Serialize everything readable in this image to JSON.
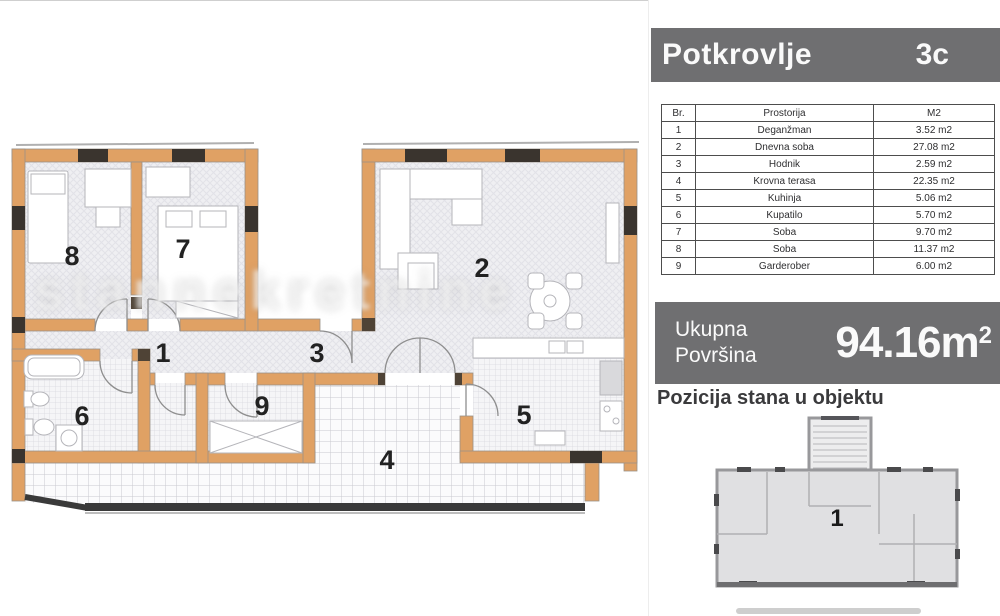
{
  "header": {
    "title": "Potkrovlje",
    "unit": "3c"
  },
  "table": {
    "columns": [
      "Br.",
      "Prostorija",
      "M2"
    ],
    "rows": [
      [
        "1",
        "Deganžman",
        "3.52 m2"
      ],
      [
        "2",
        "Dnevna soba",
        "27.08 m2"
      ],
      [
        "3",
        "Hodnik",
        "2.59 m2"
      ],
      [
        "4",
        "Krovna terasa",
        "22.35 m2"
      ],
      [
        "5",
        "Kuhinja",
        "5.06 m2"
      ],
      [
        "6",
        "Kupatilo",
        "5.70 m2"
      ],
      [
        "7",
        "Soba",
        "9.70 m2"
      ],
      [
        "8",
        "Soba",
        "11.37 m2"
      ],
      [
        "9",
        "Garderober",
        "6.00 m2"
      ]
    ]
  },
  "total": {
    "label_line1": "Ukupna",
    "label_line2": "Površina",
    "value": "94.16m",
    "sup": "2"
  },
  "position_section": {
    "heading": "Pozicija stana u objektu",
    "minimap_unit": "1"
  },
  "plan": {
    "room_numbers": [
      "1",
      "2",
      "3",
      "4",
      "5",
      "6",
      "7",
      "8",
      "9"
    ]
  },
  "watermark": {
    "text": "stannekretnine"
  },
  "colors": {
    "banner_bg": "#6f6f71",
    "wall": "#e0a164",
    "window_dark": "#3a342e",
    "railing": "#3a3a3a"
  }
}
